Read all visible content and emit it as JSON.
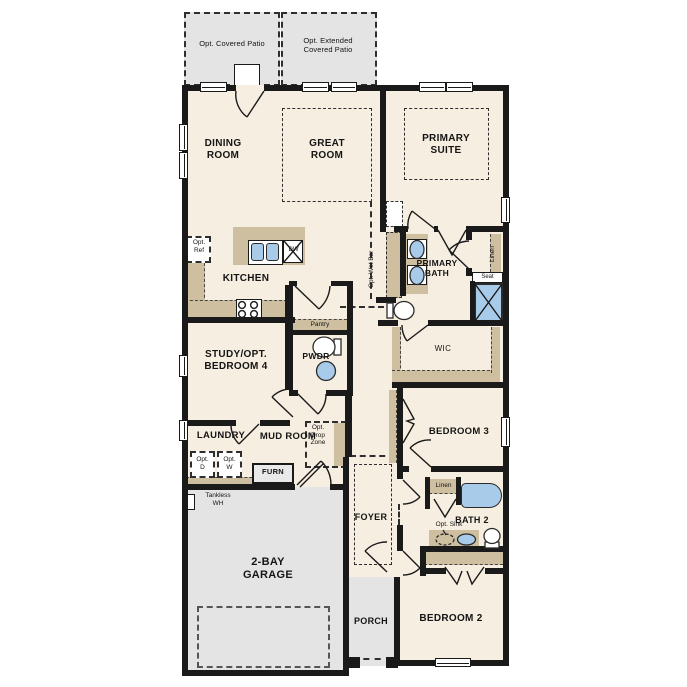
{
  "floorplan": {
    "title": "Single-story floor plan",
    "labels": {
      "covered_patio": "Opt. Covered Patio",
      "extended_patio": "Opt. Extended\nCovered Patio",
      "dining": "DINING\nROOM",
      "great": "GREAT\nROOM",
      "primary_suite": "PRIMARY\nSUITE",
      "kitchen": "KITCHEN",
      "opt_ref": "Opt.\nRef",
      "dw": "DW",
      "pantry": "Pantry",
      "pwdr": "PWDR",
      "opt_wet_bar": "Opt. Wet Bar",
      "primary_bath": "PRIMARY\nBATH",
      "linen": "Linen",
      "seat": "Seat",
      "wic": "WIC",
      "study": "STUDY/OPT.\nBEDROOM 4",
      "laundry": "LAUNDRY",
      "mud_room": "MUD ROOM",
      "opt_drop_zone": "Opt.\nDrop\nZone",
      "opt_d": "Opt.\nD",
      "opt_w": "Opt.\nW",
      "furn": "FURN",
      "tankless_wh": "Tankless\nWH",
      "garage": "2-BAY\nGARAGE",
      "foyer": "FOYER",
      "porch": "PORCH",
      "bedroom2": "BEDROOM 2",
      "bedroom3": "BEDROOM 3",
      "bath2": "BATH 2",
      "opt_sink": "Opt. Sink"
    },
    "colors": {
      "wall": "#1a1a1a",
      "interior_floor": "#f6eee0",
      "concrete": "#e4e4e4",
      "casework": "#cdbf9f",
      "fixture_blue": "#a9cbea"
    }
  }
}
